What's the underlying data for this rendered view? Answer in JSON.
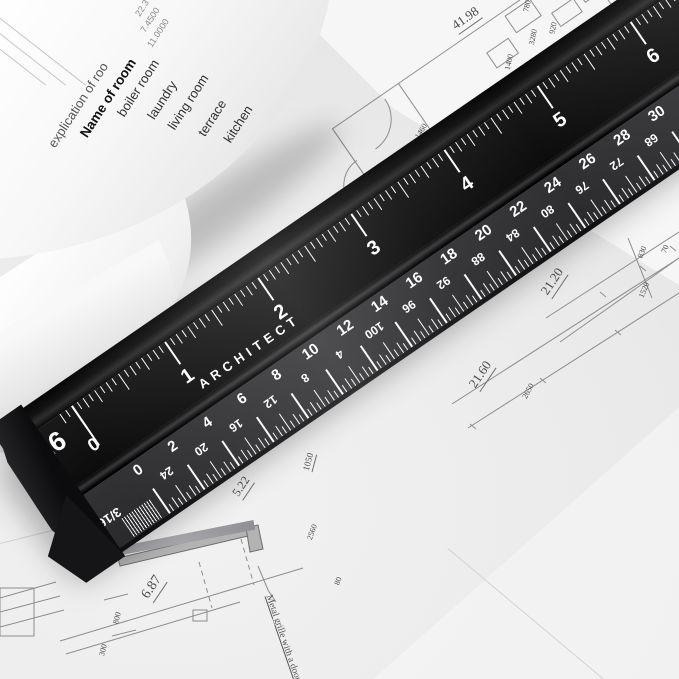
{
  "rolled_sheet_table": {
    "header_partial": "explication of roo",
    "column_header": "Name of room",
    "rooms": [
      "boiler room",
      "laundry",
      "living room",
      "terrace",
      "kitchen",
      "hall",
      "room"
    ],
    "area_values": [
      "22.3",
      "7.4500",
      "11.0000"
    ]
  },
  "ruler": {
    "brand_text": "ARCHITECT",
    "upper_scale": {
      "label": "16",
      "zero_label": "0",
      "inch_numbers": [
        "1",
        "2",
        "3",
        "4",
        "5",
        "6"
      ]
    },
    "lower_scale": {
      "fraction_label": "3/16",
      "upright_numbers": [
        "0",
        "2",
        "4",
        "6",
        "8",
        "10",
        "12",
        "14",
        "16",
        "18",
        "20",
        "22",
        "24",
        "26",
        "28",
        "30"
      ],
      "inverted_numbers": [
        "24",
        "20",
        "16",
        "12",
        "8",
        "4",
        "100",
        "96",
        "92",
        "88",
        "84",
        "80",
        "76",
        "72",
        "68",
        "64"
      ]
    },
    "colors": {
      "body": "#121212",
      "lower_face": "#313134",
      "markings": "#ffffff"
    }
  },
  "blueprint": {
    "dims": {
      "d4198": "41.98",
      "d6549": "65.49",
      "d2120": "21.20",
      "d2160": "21.60",
      "d522": "5.22",
      "d687": "6.87",
      "d1050": "1050",
      "d2650": "2650",
      "d3700": "3700",
      "d1460": "1460",
      "d3280": "3280",
      "d1400": "1400",
      "d920": "920",
      "d380": "380",
      "d780": "780",
      "d830": "830",
      "d70": "70",
      "d1520": "1520",
      "d2560": "2560",
      "d800": "800",
      "d300": "300",
      "d80": "80"
    },
    "annotation": "Metal grille with a door"
  }
}
